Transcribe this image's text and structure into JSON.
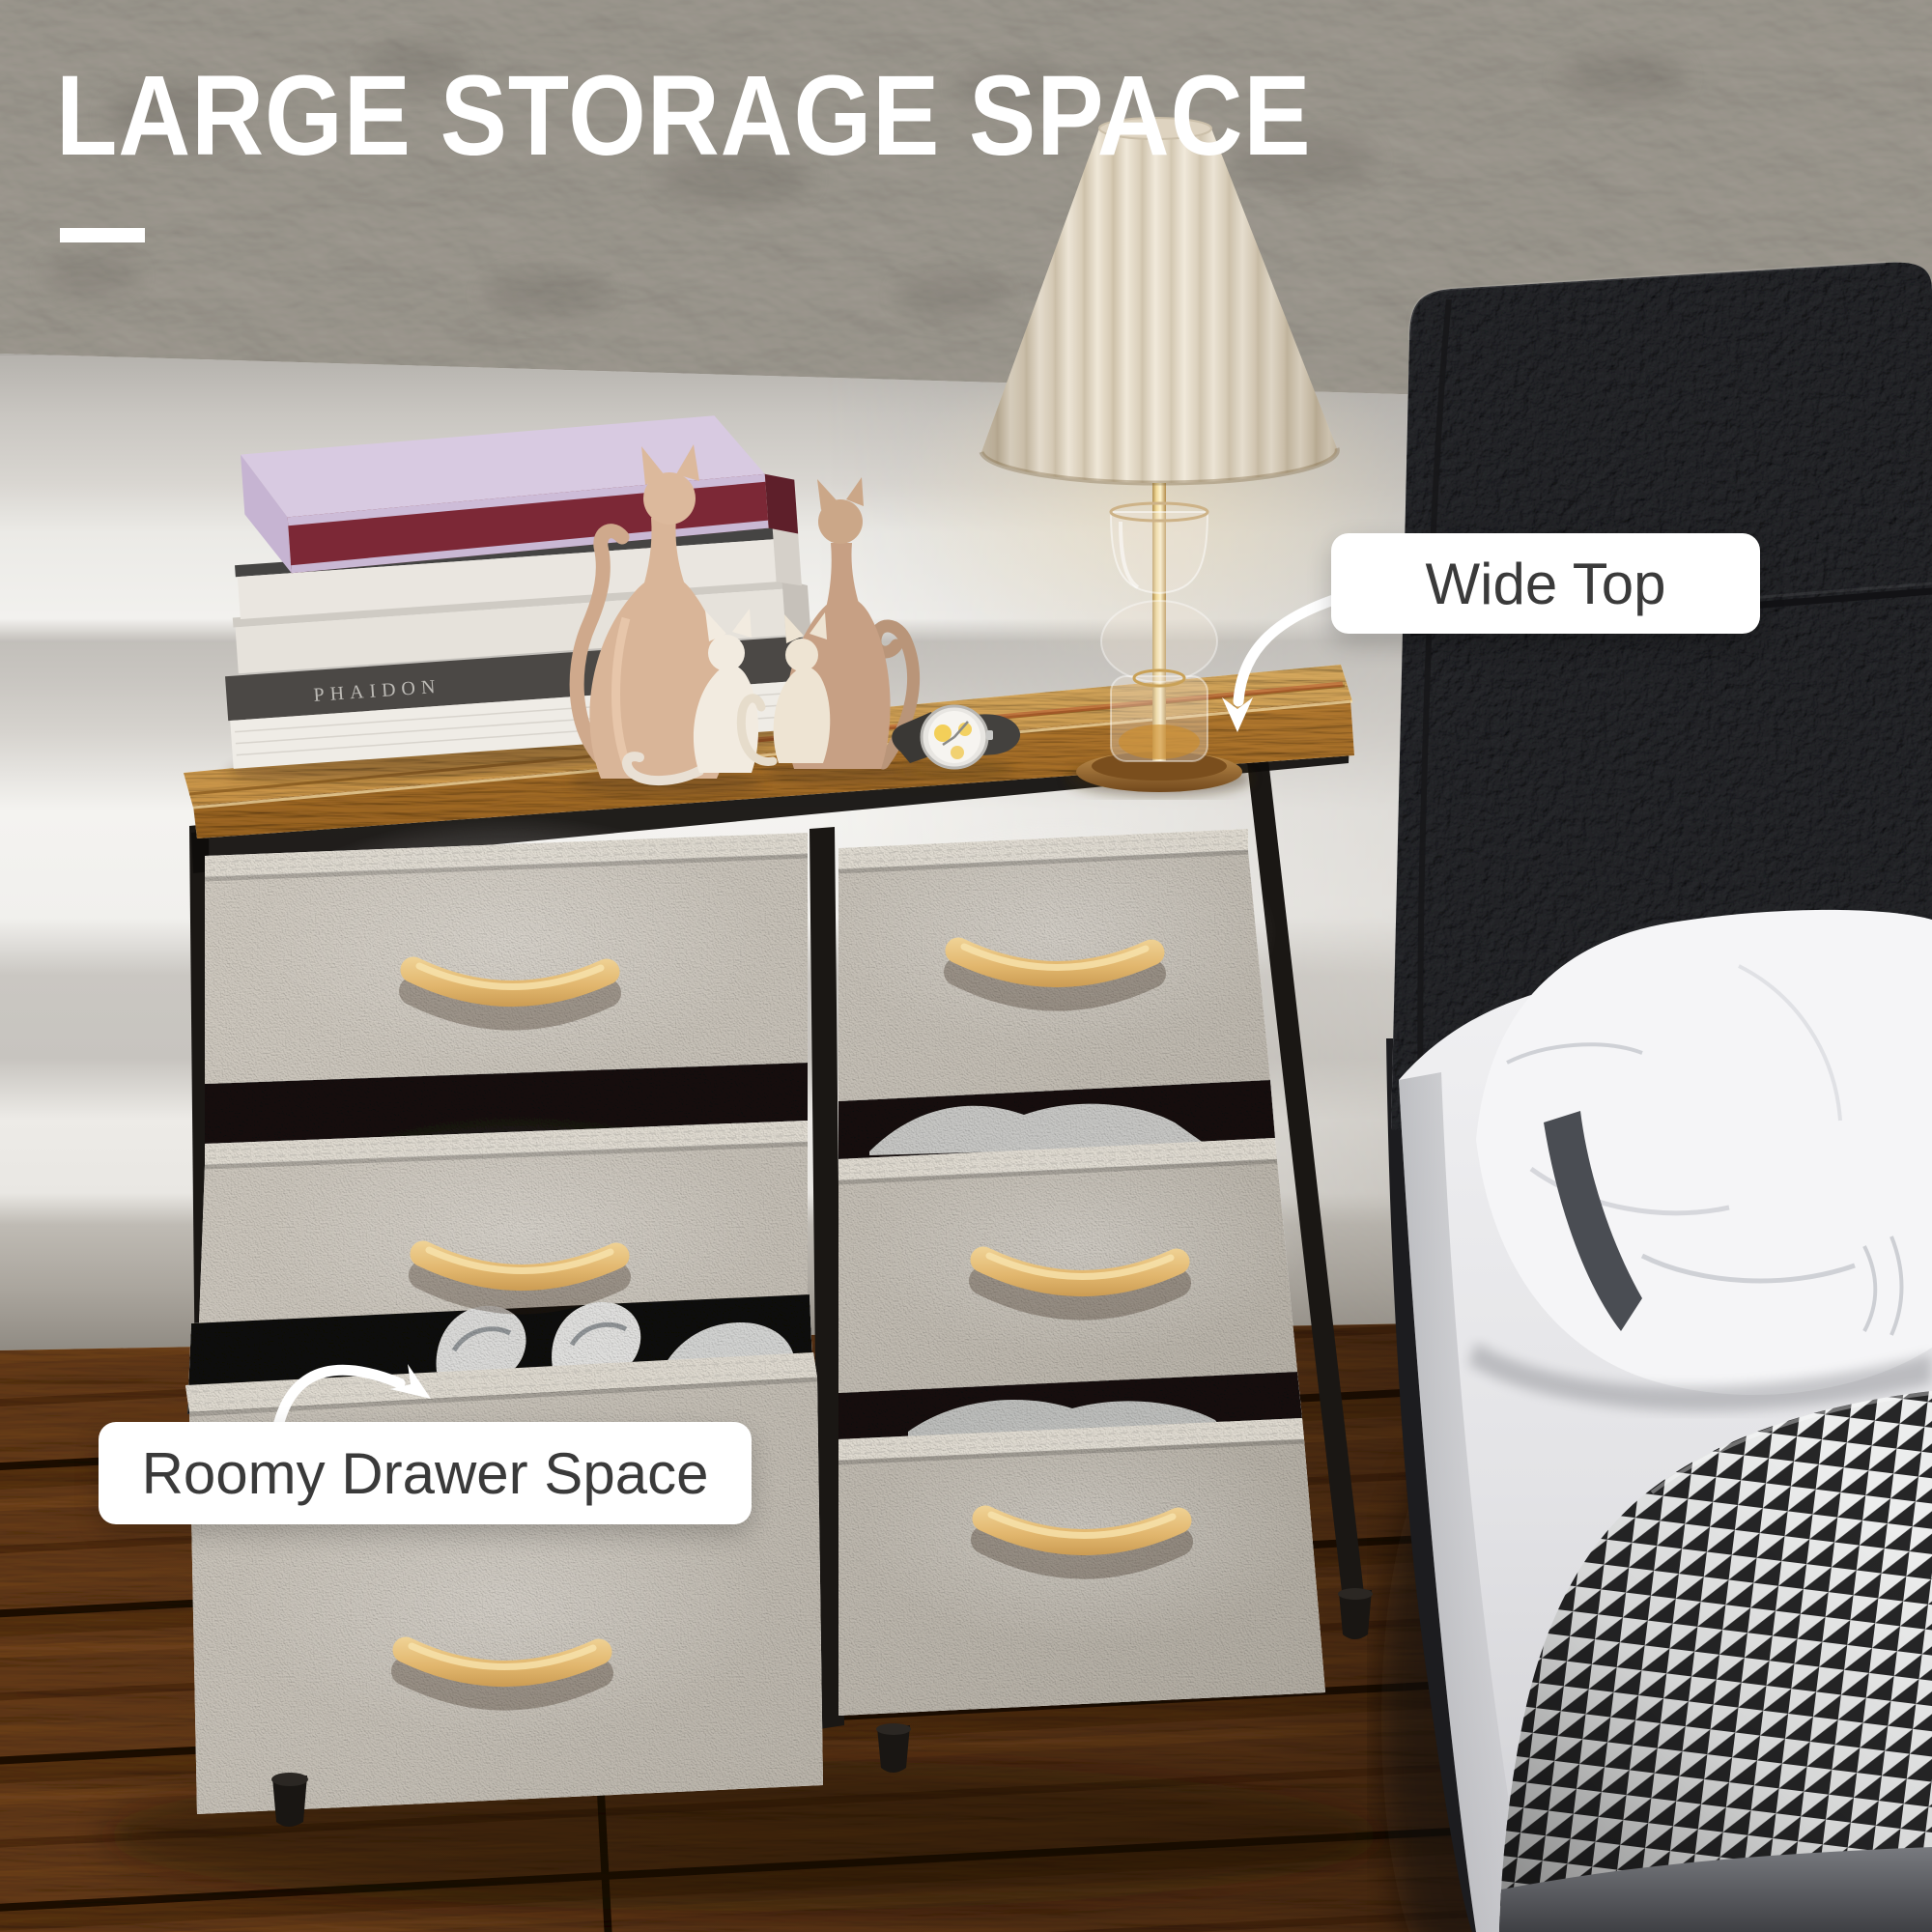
{
  "title": {
    "text": "LARGE STORAGE SPACE",
    "color": "#ffffff"
  },
  "callouts": {
    "wide_top": {
      "label": "Wide Top"
    },
    "roomy_drawer": {
      "label": "Roomy Drawer Space"
    }
  },
  "decor": {
    "book_spine_text": "PHAIDON"
  },
  "palette": {
    "wall_concrete": "#a19e99",
    "wall_band_light": "#f2f1ee",
    "wall_band_mid": "#c6c3be",
    "wood_top": "#e2ae5f",
    "floor_wood": "#5d4527",
    "drawer_fabric": "#cdc9c2",
    "handle_wood": "#e7c07c",
    "headboard_leather": "#2a2b2e",
    "blanket_dark": "#262627",
    "blanket_light": "#eceded",
    "callout_text": "#3a3a3a"
  }
}
